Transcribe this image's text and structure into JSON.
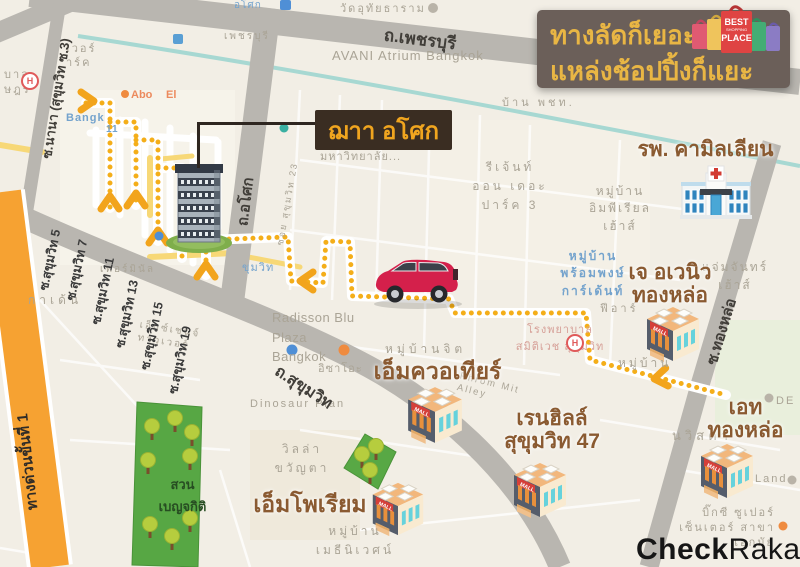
{
  "banner": {
    "line1": "ทางลัดก็เยอะ",
    "line2": "แหล่งช้อปปิ้งก็แยะ",
    "badge": {
      "best": "BEST",
      "shopping": "SHOPPING",
      "place": "PLACE"
    }
  },
  "callout": {
    "title": "ฌาา อโศก"
  },
  "logo": {
    "bold": "Check",
    "light": "Raka"
  },
  "mall_sign": "MALL",
  "pins": {
    "hospital_letter": "H"
  },
  "colors": {
    "route_yellow": "#f4ae19",
    "road_gray": "#b9b6b0",
    "expressway_orange": "#f6a232",
    "park_green": "#57a744",
    "banner_bg": "#6b5f59",
    "banner_gold": "#e9b644",
    "label_brown": "#8a5a31",
    "callout_bg": "#3a2d22",
    "car_red": "#d4204b"
  },
  "roads": {
    "phetchaburi": "ถ.เพชรบุรี",
    "sukhumvit": "ถ.สุขุมวิท",
    "asok": "ถ.อโศก",
    "thonglor": "ซ.ทองหล่อ",
    "nana": "ซ.นานา (สุขุมวิท ซ.3)",
    "expressway": "ทางด่วนขั้นที่ 1",
    "sois": [
      "ซ.สุขุมวิท 5",
      "ซ.สุขุมวิท 7",
      "ซ.สุขุมวิท 11",
      "ซ.สุขุมวิท 13",
      "ซ.สุขุมวิท 15",
      "ซ.สุขุมวิท 19"
    ]
  },
  "places": {
    "camillian": "รพ. คามิลเลียน",
    "emquartier": "เอ็มควอเทียร์",
    "rainhill": "เรนฮิลล์\nสุขุมวิท 47",
    "emporium": "เอ็มโพเรียม",
    "javenue": "เจ อเวนิว\nทองหล่อ",
    "eight": "เอท\nทองหล่อ",
    "park": "สวน\nเบญจกิติ"
  },
  "map_texts": {
    "wat": "วัดอุทัยธาราม",
    "avani": "AVANI Atrium Bangkok",
    "phetchaburi_small": "เพชรบุรี",
    "baan": "บ้าน พชท.",
    "regent": "รีเจ้นท์\nออน เดอะ\nปาร์ค 3",
    "imperial": "หมู่บ้าน\nอิมพีเรียล\nเฮ้าส์",
    "prompong": "หมู่บ้าน\nพร้อมพงษ์\nการ์เด้นท์",
    "jamjan": "แจ่มจันทร์\nเฮ้าส์",
    "feear": "ฟีอาร์",
    "university": "มหาวิทยาลัย...",
    "soi23": "ซอย สุขุมวิท 23",
    "radisson": "Radisson Blu\nPlaza Bangkok",
    "isao": "อิซาโอะ",
    "dinosaur": "Dinosaur Plan",
    "villa": "วิลล่า\nขวัญตา",
    "baanjit": "หมู่บ้านจิต",
    "samitivej": "โรงพยาบาล\nสมิติเวช สุขุมวิท",
    "phrommit": "Phrom Mit Alley",
    "methiniwet": "หมู่บ้าน\nเมธีนิเวศน์",
    "exchange": "เอ็กซ์เชนจ์ทาวเวอร์",
    "terminal": "เทอร์มินัล",
    "garden": "กาเด้น",
    "bangk": "Bangk",
    "eleven": "11",
    "abo": "Abo",
    "el": "El",
    "sukhumvit_station": "ขุมวิท",
    "asok_station": "อโศก",
    "hospital_frag": "บาล\nษฎร์",
    "tower_park": "เวอร์\nาร์ค",
    "bigc": "บิ๊กซี ซูเปอร์\nเซ็นเตอร์ สาขาเอกมัย",
    "land": "Land",
    "de": "DE",
    "nvista": "นวิสต้า",
    "baan_right": "หมู่บ้าน"
  }
}
